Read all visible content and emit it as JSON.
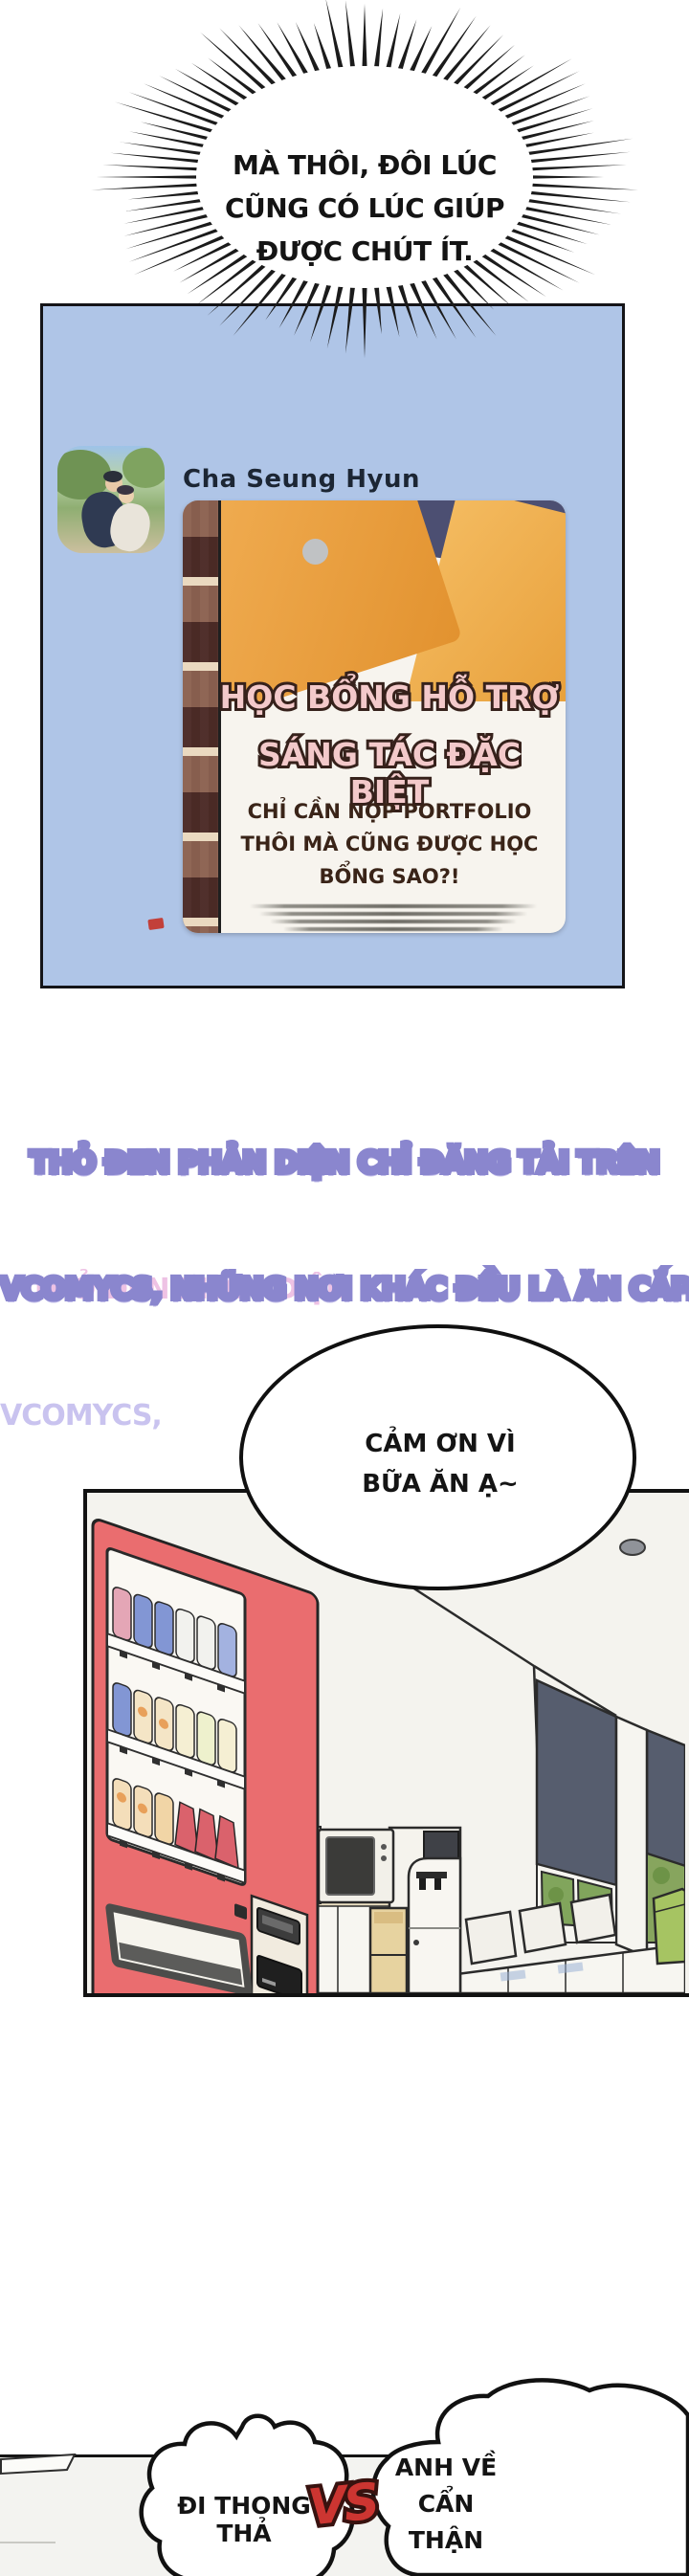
{
  "top_bubble": {
    "lines": [
      "MÀ THÔI, ĐÔI LÚC",
      "CŨNG CÓ LÚC GIÚP",
      "ĐƯỢC CHÚT ÍT."
    ]
  },
  "chat_panel": {
    "profile_name": "Cha Seung Hyun",
    "poster": {
      "title_line1": "HỌC BỔNG HỖ TRỢ",
      "title_line2": "SÁNG TÁC ĐẶC BIỆT",
      "subtitle_lines": [
        "CHỈ CẦN NỘP PORTFOLIO",
        "THÔI MÀ CŨNG ĐƯỢC HỌC",
        "BỔNG SAO?!"
      ]
    }
  },
  "watermark": {
    "line1_full": "THỎ ĐEN PHẢN DIỆN CHỈ ĐĂNG TẢI TRÊN",
    "line1_highlight": "THỎ ĐEN PHẢN DIỆN",
    "line1_rest": " CHỈ ĐĂNG TẢI TRÊN",
    "line2_full": "VCOMYCS, NHỮNG NƠI KHÁC ĐỀU LÀ ĂN CẮP.",
    "line2_highlight": "VCOMYCS,",
    "line2_rest": " NHỮNG NƠI KHÁC ĐỀU LÀ ĂN CẮP."
  },
  "thanks_bubble": {
    "lines": [
      "CẢM ƠN VÌ",
      "BỮA ĂN Ạ~"
    ]
  },
  "farewell": {
    "left_bubble": "ĐI THONG THẢ",
    "vs": "VS",
    "right_bubble_lines": [
      "ANH VỀ",
      "CẨN THẬN"
    ]
  },
  "colors": {
    "chat_panel_blue": "#afc5e7",
    "poster_title_pink": "#f3c9ca",
    "poster_outline_brown": "#36211b",
    "watermark_purple": "#8a86ce",
    "watermark_pink": "#eec2e4",
    "vending_machine_red": "#ea6d6f",
    "vs_red": "#cc3531",
    "window_shade_navy": "#565d6e",
    "tree_green": "#87a55e",
    "bin_green": "#a6c462",
    "cubby_tan": "#e7d3a0"
  }
}
